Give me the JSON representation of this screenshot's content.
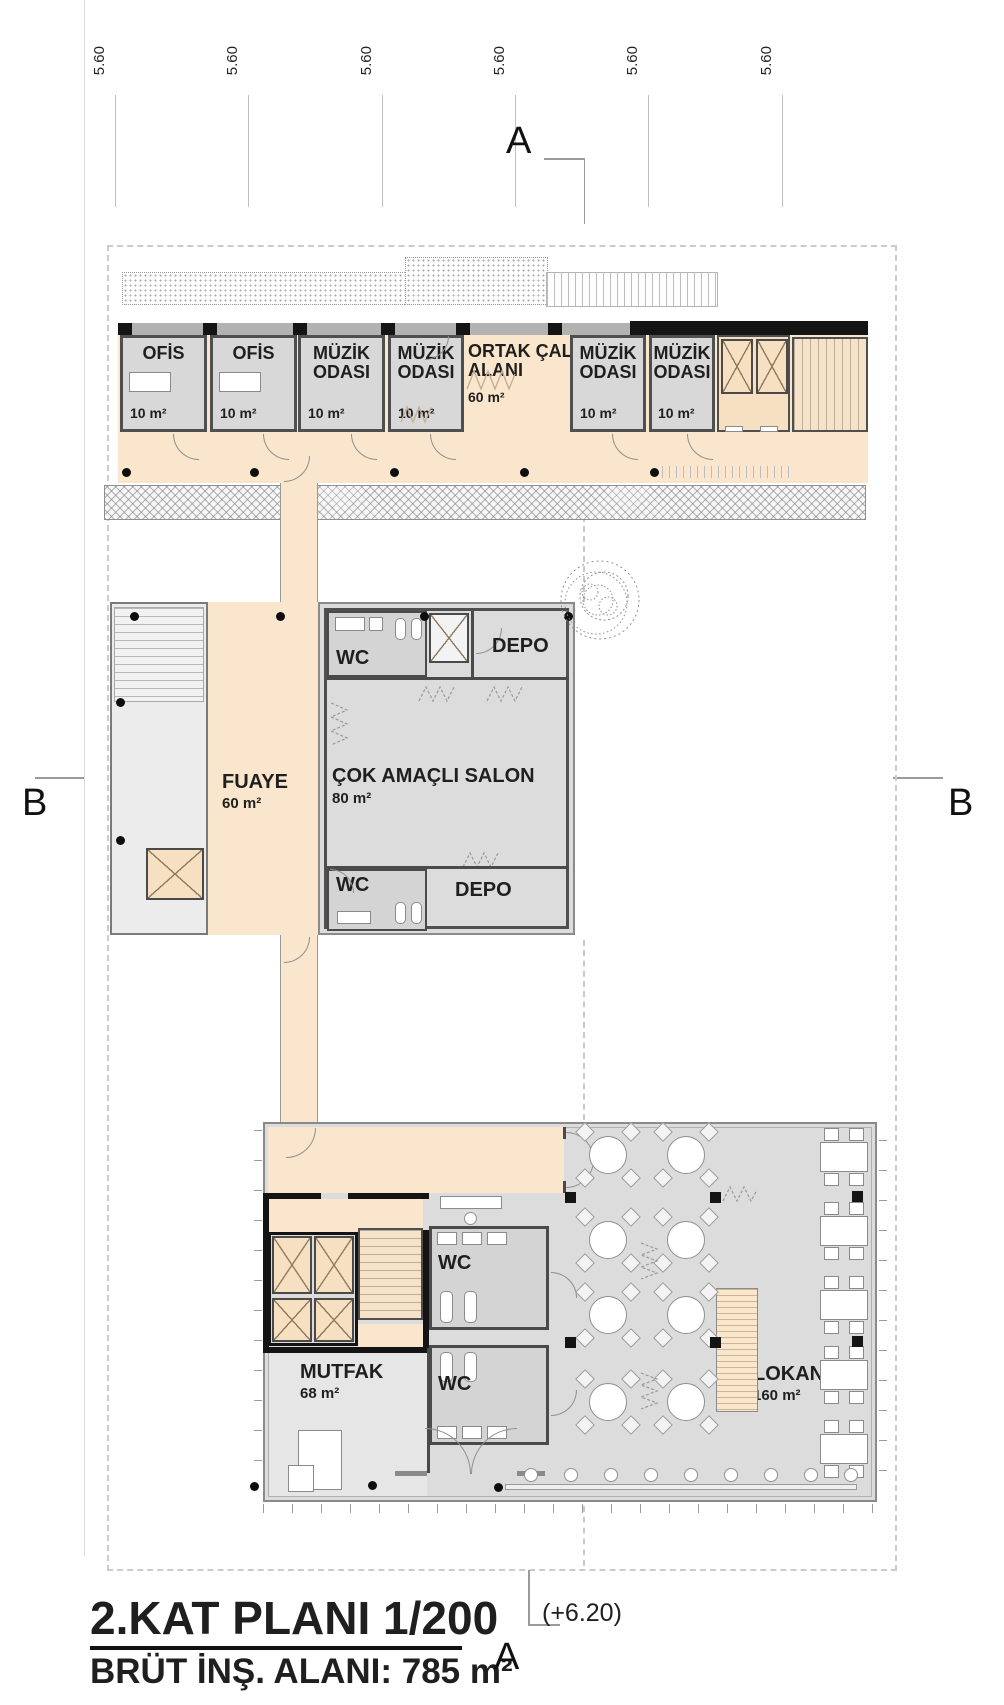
{
  "grid": {
    "dim": "5.60"
  },
  "markers": {
    "a": "A",
    "b": "B",
    "elevation": "(+6.20)"
  },
  "title": {
    "line1": "2.KAT PLANI 1/200",
    "line2": "BRÜT İNŞ. ALANI: 785 m²"
  },
  "top_wing": {
    "rooms": [
      {
        "name": "OFİS",
        "area": "10 m²"
      },
      {
        "name": "OFİS",
        "area": "10 m²"
      },
      {
        "name": "MÜZİK ODASI",
        "area": "10 m²"
      },
      {
        "name": "MÜZİK ODASI",
        "area": "10 m²"
      },
      {
        "name": "ORTAK ÇALIŞMA ALANI",
        "area": "60 m²"
      },
      {
        "name": "MÜZİK ODASI",
        "area": "10 m²"
      },
      {
        "name": "MÜZİK ODASI",
        "area": "10 m²"
      }
    ]
  },
  "mid": {
    "wc_top": "WC",
    "depo_top": "DEPO",
    "fuaye_name": "FUAYE",
    "fuaye_area": "60 m²",
    "salon_name": "ÇOK AMAÇLI SALON",
    "salon_area": "80 m²",
    "wc_bottom": "WC",
    "depo_bottom": "DEPO"
  },
  "bottom": {
    "wc1": "WC",
    "wc2": "WC",
    "mutfak_name": "MUTFAK",
    "mutfak_area": "68 m²",
    "lokanta_name": "LOKANTA",
    "lokanta_area": "160 m²"
  },
  "colors": {
    "corridor_peach": "#f9e6cc",
    "room_gray": "#d8d8d8",
    "wall_dark": "#4a4a4a",
    "wall_black": "#141414"
  }
}
